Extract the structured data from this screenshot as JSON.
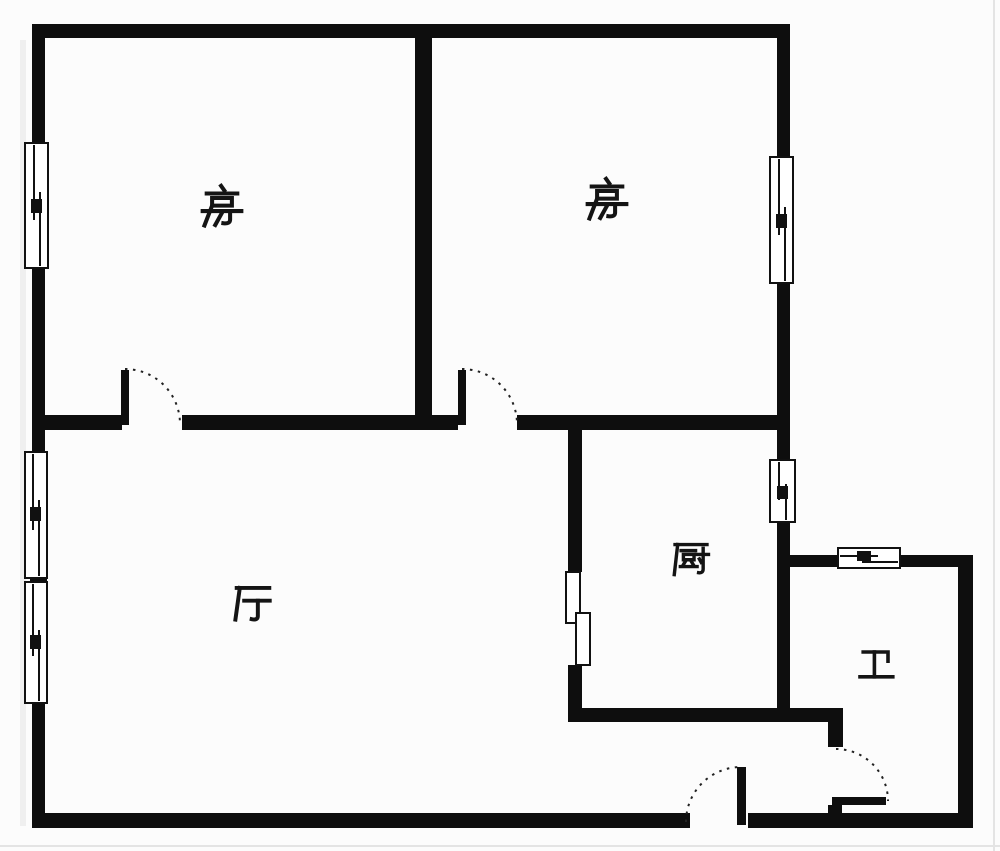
{
  "page": {
    "kind": "floor-plan-drawing",
    "background_color": "#fcfcfc",
    "wall_color": "#0e0e0e",
    "symbol_line_color": "#1c1c1c",
    "edge_guide_color": "#e4e4e4"
  },
  "floor_plan": {
    "rooms": [
      {
        "id": "bedroom-1",
        "label": "房"
      },
      {
        "id": "bedroom-2",
        "label": "房"
      },
      {
        "id": "living-room",
        "label": "厅"
      },
      {
        "id": "kitchen",
        "label": "厨"
      },
      {
        "id": "bathroom",
        "label": "卫"
      }
    ],
    "window_symbol_count": 6,
    "sliding_panel_count": 2,
    "swing_door_count": 4
  }
}
